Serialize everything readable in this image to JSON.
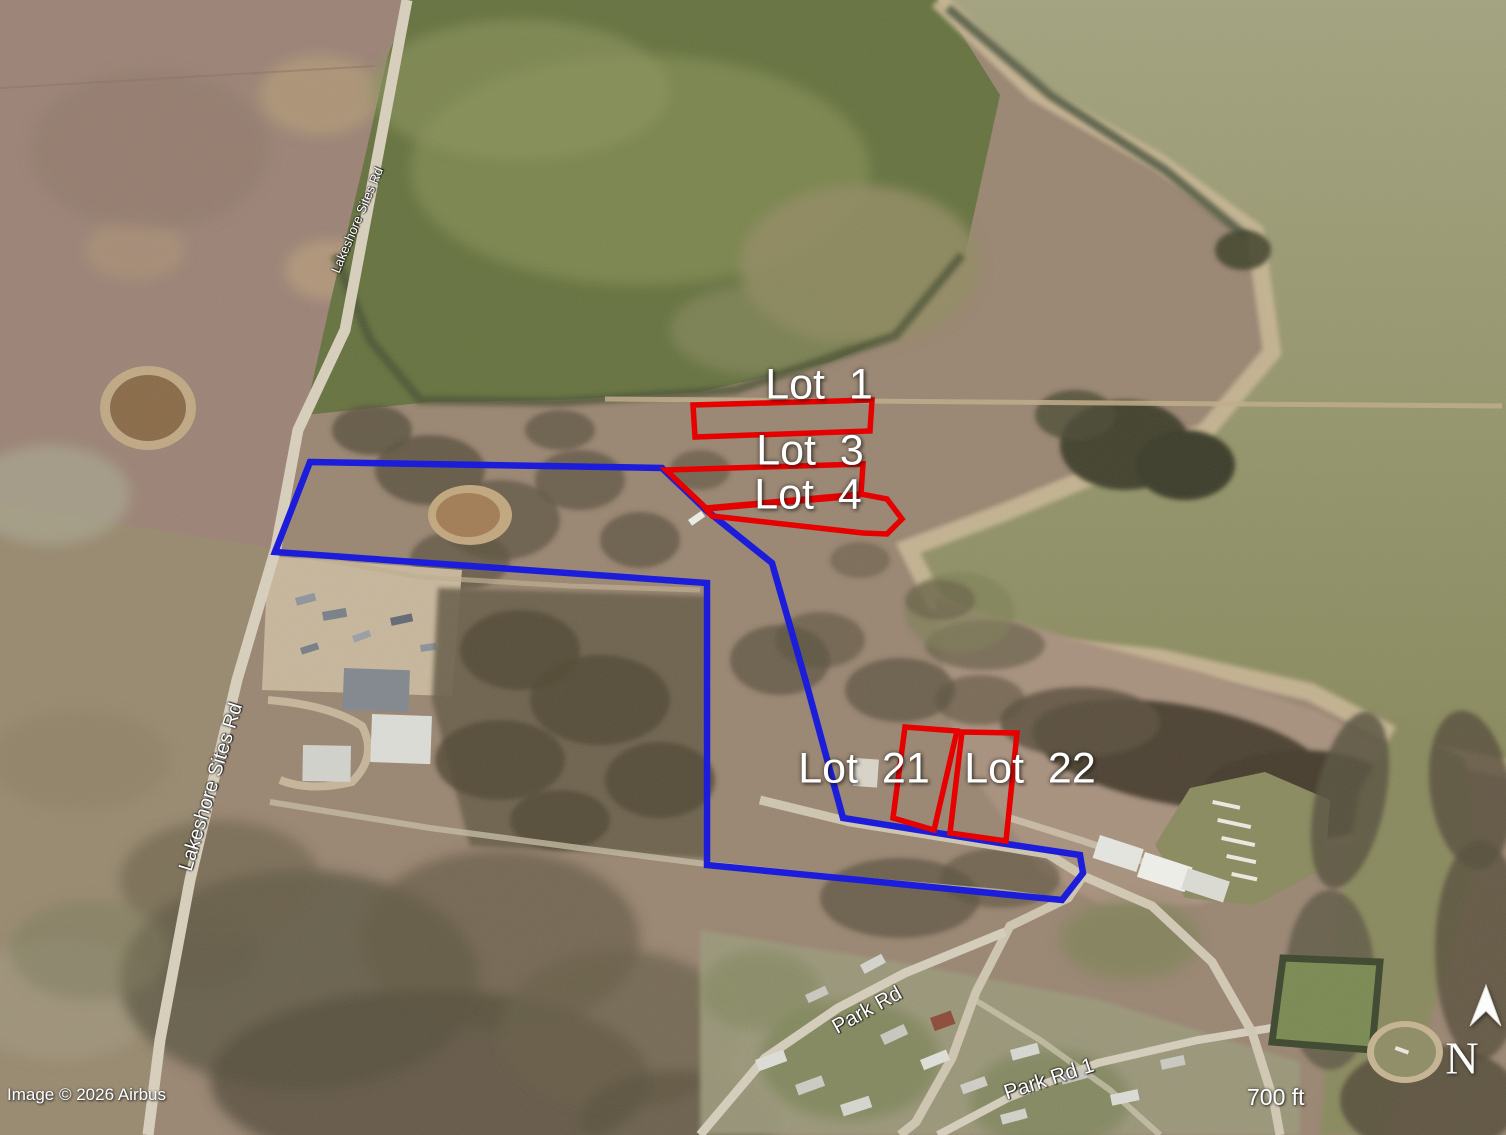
{
  "map": {
    "attribution": "Image © 2026 Airbus",
    "scale_label": "700 ft",
    "north_label": "N",
    "overlay_colors": {
      "lot_outline": "#e60000",
      "boundary_outline": "#1c1cdb",
      "label_text": "#ffffff"
    },
    "boundary": {
      "id": "property-boundary",
      "points": "310,462 662,468 706,510 772,563 806,682 843,818 1000,843 1080,855 1083,873 1062,900 707,865 707,583 275,552"
    },
    "lots": [
      {
        "id": "lot-1",
        "label": "Lot  1",
        "label_x": 819,
        "label_y": 385,
        "points": "693,405 872,400 870,431 695,437"
      },
      {
        "id": "lot-3",
        "label": "Lot  3",
        "label_x": 810,
        "label_y": 451,
        "points": "666,470 863,464 861,494 706,508"
      },
      {
        "id": "lot-4",
        "label": "Lot  4",
        "label_x": 808,
        "label_y": 495,
        "points": "706,509 857,496 861,494 887,499 902,519 887,534 863,533 712,516"
      },
      {
        "id": "lot-21",
        "label": "Lot  21",
        "label_x": 864,
        "label_y": 769,
        "points": "905,727 957,731 934,830 893,818"
      },
      {
        "id": "lot-22",
        "label": "Lot  22",
        "label_x": 1030,
        "label_y": 769,
        "points": "962,732 1017,733 1006,841 950,833"
      }
    ],
    "road_labels": [
      {
        "id": "lakeshore-sites-rd-north",
        "label": "Lakeshore Sites Rd",
        "x": 357,
        "y": 220,
        "rotate": -67,
        "size": 13
      },
      {
        "id": "lakeshore-sites-rd-south",
        "label": "Lakeshore Sites Rd",
        "x": 211,
        "y": 787,
        "rotate": -73,
        "size": 20
      },
      {
        "id": "park-rd",
        "label": "Park Rd",
        "x": 867,
        "y": 1010,
        "rotate": -29,
        "size": 21
      },
      {
        "id": "park-rd-1",
        "label": "Park Rd 1",
        "x": 1049,
        "y": 1079,
        "rotate": -18,
        "size": 21
      }
    ]
  }
}
